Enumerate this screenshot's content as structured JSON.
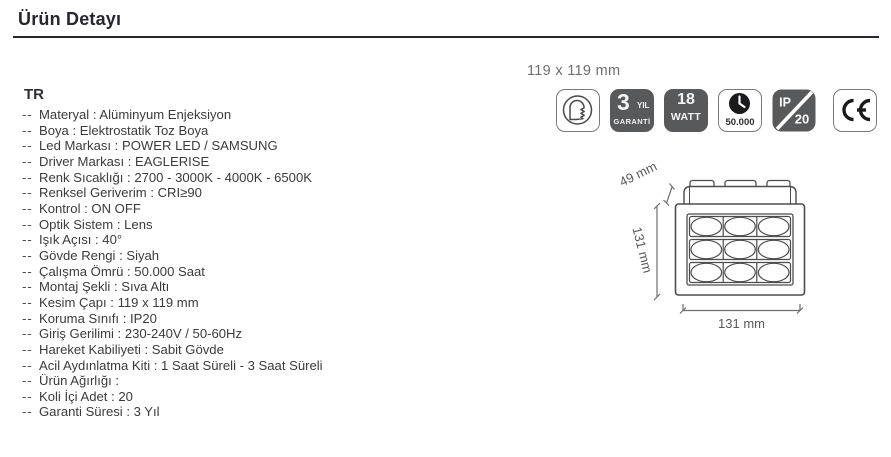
{
  "header": {
    "title": "Ürün Detayı"
  },
  "content": {
    "lang": "TR",
    "bullet": "--",
    "specs": [
      {
        "label": "Materyal",
        "value": "Alüminyum Enjeksiyon"
      },
      {
        "label": "Boya",
        "value": "Elektrostatik Toz Boya"
      },
      {
        "label": "Led Markası",
        "value": "POWER LED / SAMSUNG"
      },
      {
        "label": "Driver Markası",
        "value": "EAGLERISE"
      },
      {
        "label": "Renk Sıcaklığı",
        "value": "2700 - 3000K - 4000K - 6500K"
      },
      {
        "label": "Renksel Geriverim",
        "value": "CRI≥90"
      },
      {
        "label": "Kontrol",
        "value": "ON OFF"
      },
      {
        "label": "Optik Sistem",
        "value": "Lens"
      },
      {
        "label": "Işık Açısı",
        "value": "40°"
      },
      {
        "label": "Gövde Rengi",
        "value": "Siyah"
      },
      {
        "label": "Çalışma Ömrü",
        "value": "50.000 Saat"
      },
      {
        "label": "Montaj Şekli",
        "value": "Sıva Altı"
      },
      {
        "label": "Kesim Çapı",
        "value": "119 x 119 mm"
      },
      {
        "label": "Koruma Sınıfı",
        "value": "IP20"
      },
      {
        "label": "Giriş Gerilimi",
        "value": "230-240V / 50-60Hz"
      },
      {
        "label": "Hareket Kabiliyeti",
        "value": "Sabit Gövde"
      },
      {
        "label": "Acil Aydınlatma Kiti",
        "value": "1 Saat Süreli - 3 Saat Süreli"
      },
      {
        "label": "Ürün Ağırlığı",
        "value": ""
      },
      {
        "label": "Koli İçi Adet",
        "value": "20"
      },
      {
        "label": "Garanti Süresi",
        "value": "3 Yıl"
      }
    ]
  },
  "badges": {
    "size_label": "119 x 119 mm",
    "warranty": {
      "number": "3",
      "unit": "YIL",
      "word": "GARANTİ"
    },
    "watt": {
      "number": "18",
      "unit": "WATT"
    },
    "lifetime": {
      "hours": "50.000"
    },
    "ip_rating": {
      "prefix": "IP",
      "value": "20"
    }
  },
  "drawing": {
    "depth_label": "49 mm",
    "side_label": "131 mm",
    "width_label": "131 mm"
  },
  "colors": {
    "badge_dark": "#58595b",
    "drawing_line": "#4d4d4f",
    "dim_text": "#58595b",
    "title": "#26262e",
    "body_text": "#3b3b3d",
    "muted": "#6d6e70"
  }
}
